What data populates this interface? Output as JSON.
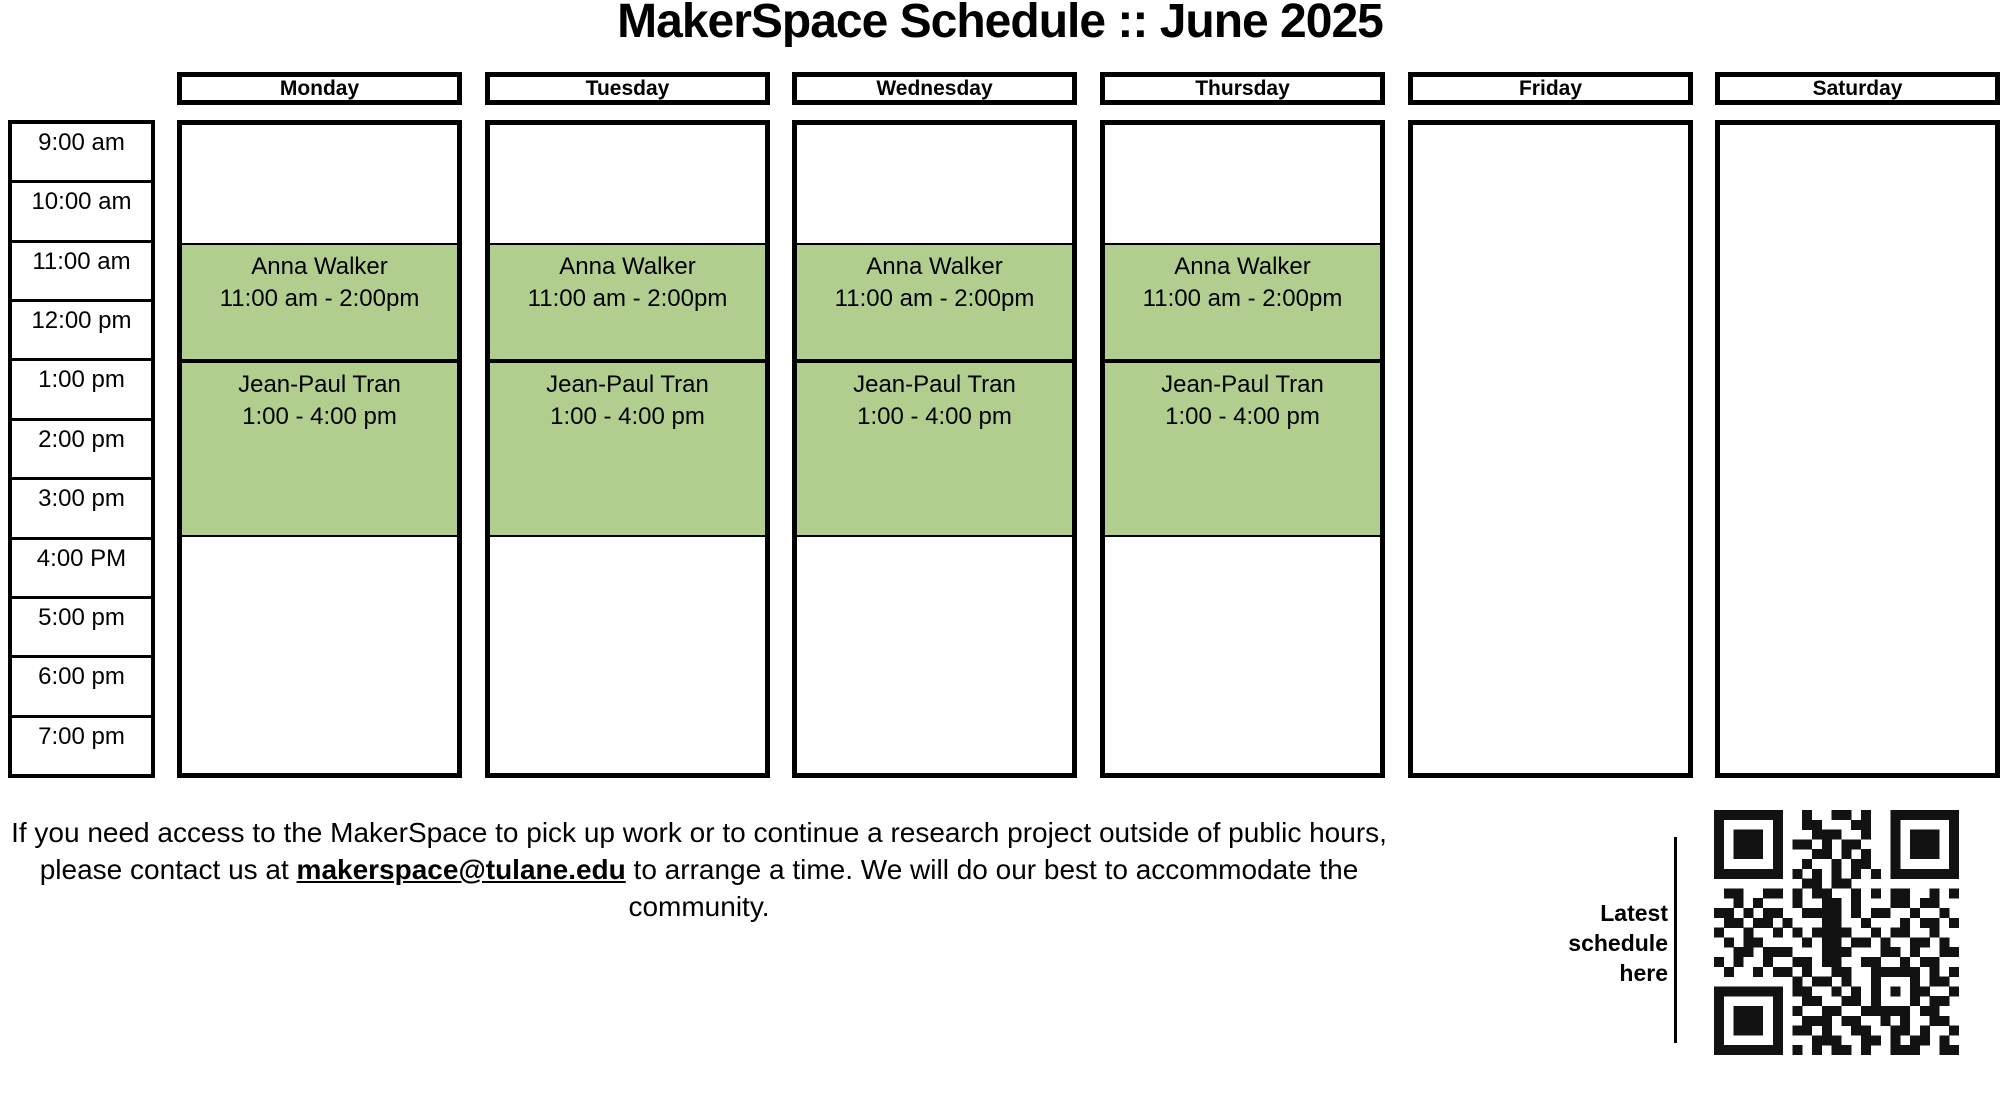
{
  "title": "MakerSpace Schedule :: June 2025",
  "colors": {
    "event_green": "#b2ce8e",
    "border_black": "#000000",
    "qr_dark": "#121212"
  },
  "schedule": {
    "time_labels": [
      "9:00 am",
      "10:00 am",
      "11:00 am",
      "12:00 pm",
      "1:00 pm",
      "2:00 pm",
      "3:00 pm",
      "4:00 PM",
      "5:00 pm",
      "6:00 pm",
      "7:00 pm"
    ],
    "days": [
      {
        "label": "Monday",
        "events": [
          {
            "name": "Anna Walker",
            "time_range": "11:00 am - 2:00pm",
            "row_start": 2,
            "row_span": 2
          },
          {
            "name": "Jean-Paul Tran",
            "time_range": "1:00 - 4:00 pm",
            "row_start": 4,
            "row_span": 3
          }
        ]
      },
      {
        "label": "Tuesday",
        "events": [
          {
            "name": "Anna Walker",
            "time_range": "11:00 am - 2:00pm",
            "row_start": 2,
            "row_span": 2
          },
          {
            "name": "Jean-Paul Tran",
            "time_range": "1:00 - 4:00 pm",
            "row_start": 4,
            "row_span": 3
          }
        ]
      },
      {
        "label": "Wednesday",
        "events": [
          {
            "name": "Anna Walker",
            "time_range": "11:00 am - 2:00pm",
            "row_start": 2,
            "row_span": 2
          },
          {
            "name": "Jean-Paul Tran",
            "time_range": "1:00 - 4:00 pm",
            "row_start": 4,
            "row_span": 3
          }
        ]
      },
      {
        "label": "Thursday",
        "events": [
          {
            "name": "Anna Walker",
            "time_range": "11:00 am - 2:00pm",
            "row_start": 2,
            "row_span": 2
          },
          {
            "name": "Jean-Paul Tran",
            "time_range": "1:00 - 4:00 pm",
            "row_start": 4,
            "row_span": 3
          }
        ]
      },
      {
        "label": "Friday",
        "events": []
      },
      {
        "label": "Saturday",
        "events": []
      }
    ]
  },
  "footer": {
    "line1": "If you need access to the MakerSpace to pick up work or to continue a research project outside of public hours,",
    "line2_before": "please contact us at ",
    "email": "makerspace@tulane.edu",
    "line2_after": " to arrange a time. We will do our best to accommodate the",
    "line3": "community."
  },
  "qr": {
    "caption_lines": [
      "Latest",
      "schedule",
      "here"
    ],
    "matrix": [
      "1111111001001101001111111",
      "1000001001100011001000001",
      "1011101000111001001011101",
      "1011101011010110001011101",
      "1011101000110101001011101",
      "1000001001001011001000001",
      "1111111010101010101111111",
      "0000000001101100000000000",
      "0110011010110010101100101",
      "0010100010011010001101100",
      "1101011001111010110010010",
      "0110110100011001000101101",
      "1001001010111100101100100",
      "0101100001011011010011010",
      "0011011100011100011010011",
      "1010010011011001100101100",
      "0100101101001100111110101",
      "0000000010110100100010110",
      "1111111011001010101011001",
      "1000001001100110100010110",
      "1011101010011001111101100",
      "1011101001110110010100110",
      "1011101011010011001101001",
      "1000001000111001101011010",
      "1111111010101101001110011"
    ]
  }
}
